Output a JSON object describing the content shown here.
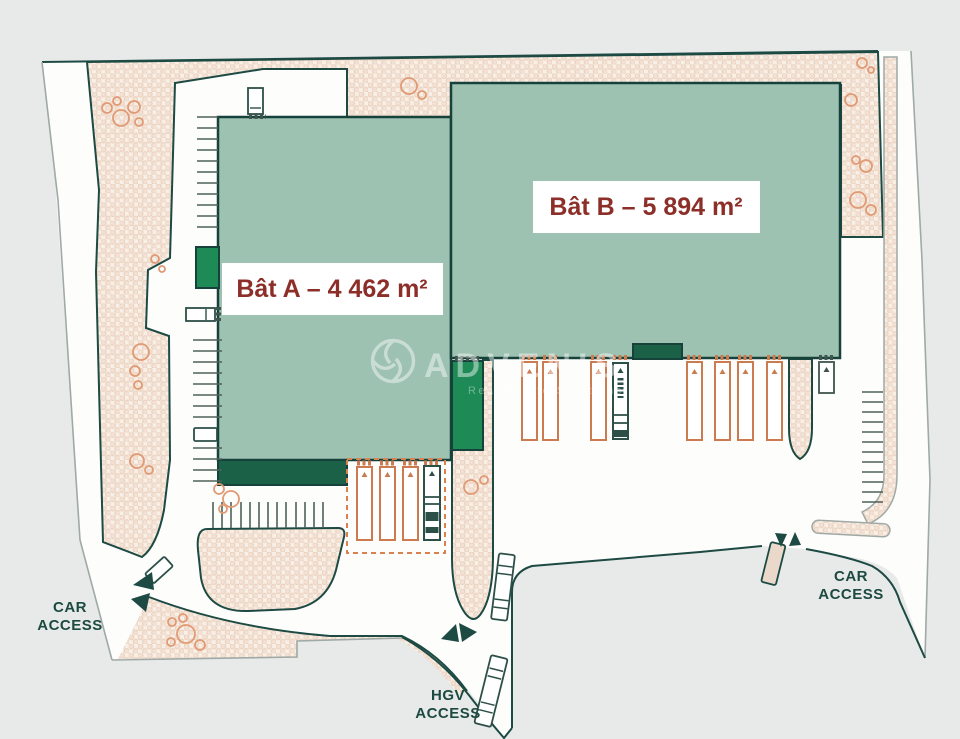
{
  "plan": {
    "buildings": [
      {
        "id": "bat-a",
        "label": "Bât A – 4 462 m²"
      },
      {
        "id": "bat-b",
        "label": "Bât B – 5 894 m²"
      }
    ],
    "access": {
      "car_left": {
        "line1": "CAR",
        "line2": "ACCESS"
      },
      "car_right": {
        "line1": "CAR",
        "line2": "ACCESS"
      },
      "hgv": {
        "line1": "HGV",
        "line2": "ACCESS"
      }
    },
    "watermark": {
      "brand": "ADVENIS",
      "tagline": "Real Estate Solutions"
    },
    "colors": {
      "background": "#e8eae9",
      "site_white": "#fdfdfc",
      "outline_dark": "#1d4a43",
      "building_fill": "#9dc2b1",
      "dock_dark_green": "#1a6147",
      "dock_bright_green": "#1e8a55",
      "bay_orange": "#cc7a50",
      "label_text": "#8d2f29",
      "landscape_base": "#f8efe7"
    }
  }
}
